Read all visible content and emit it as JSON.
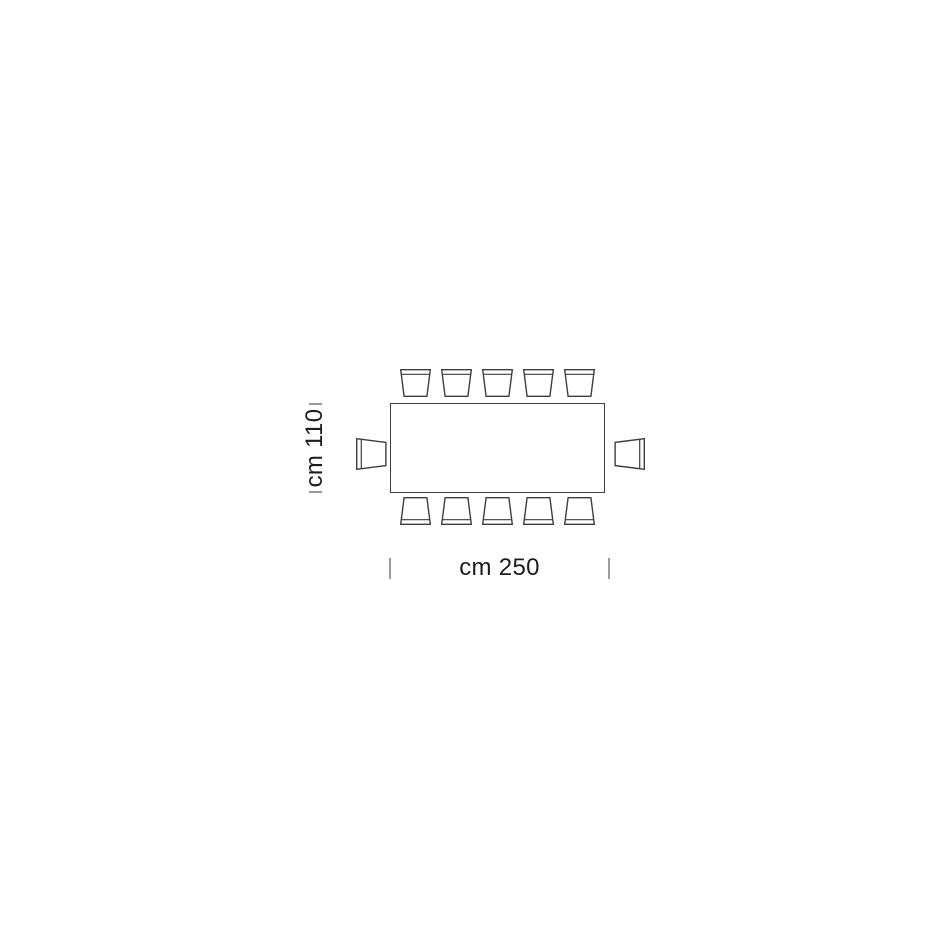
{
  "diagram": {
    "type": "furniture-plan-top-view",
    "table": {
      "shape": "rectangle",
      "width_cm": 250,
      "depth_cm": 110
    },
    "dimensions": {
      "width_label": "cm 250",
      "depth_label": "cm 110"
    },
    "seats": {
      "top": 5,
      "bottom": 5,
      "left": 1,
      "right": 1,
      "total": 12
    },
    "colors": {
      "background": "#ffffff",
      "line": "#3e3e3e",
      "tick": "#9b9b9b",
      "text": "#1d1d1d"
    }
  }
}
